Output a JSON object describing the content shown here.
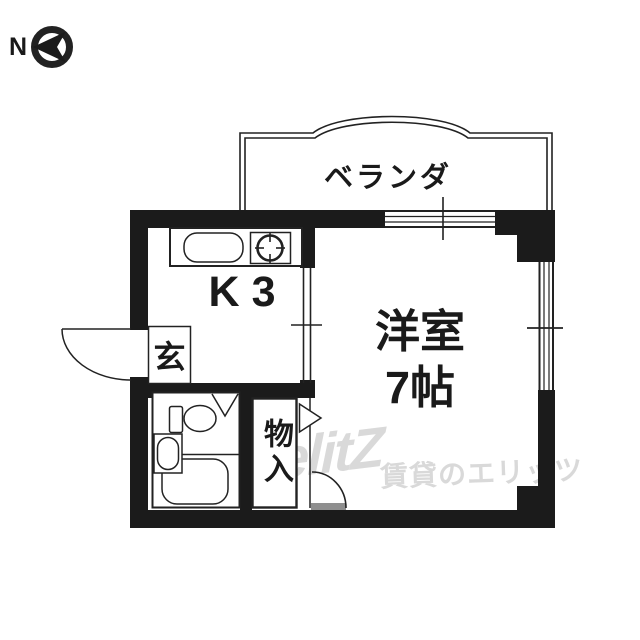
{
  "compass": {
    "label": "N",
    "icon": "north-arrow-pointing-left"
  },
  "balcony": {
    "label": "ベランダ"
  },
  "kitchen": {
    "label": "K3"
  },
  "entrance": {
    "label": "玄"
  },
  "room": {
    "name": "洋室",
    "size": "7帖"
  },
  "storage": {
    "label": "物入"
  },
  "watermark": {
    "logo": "elitZ",
    "text": "賃貸のエリッツ"
  },
  "colors": {
    "wall": "#1b1b1b",
    "line": "#222222",
    "watermark": "#d9d9d9",
    "door_gray": "#8f8f8f"
  }
}
